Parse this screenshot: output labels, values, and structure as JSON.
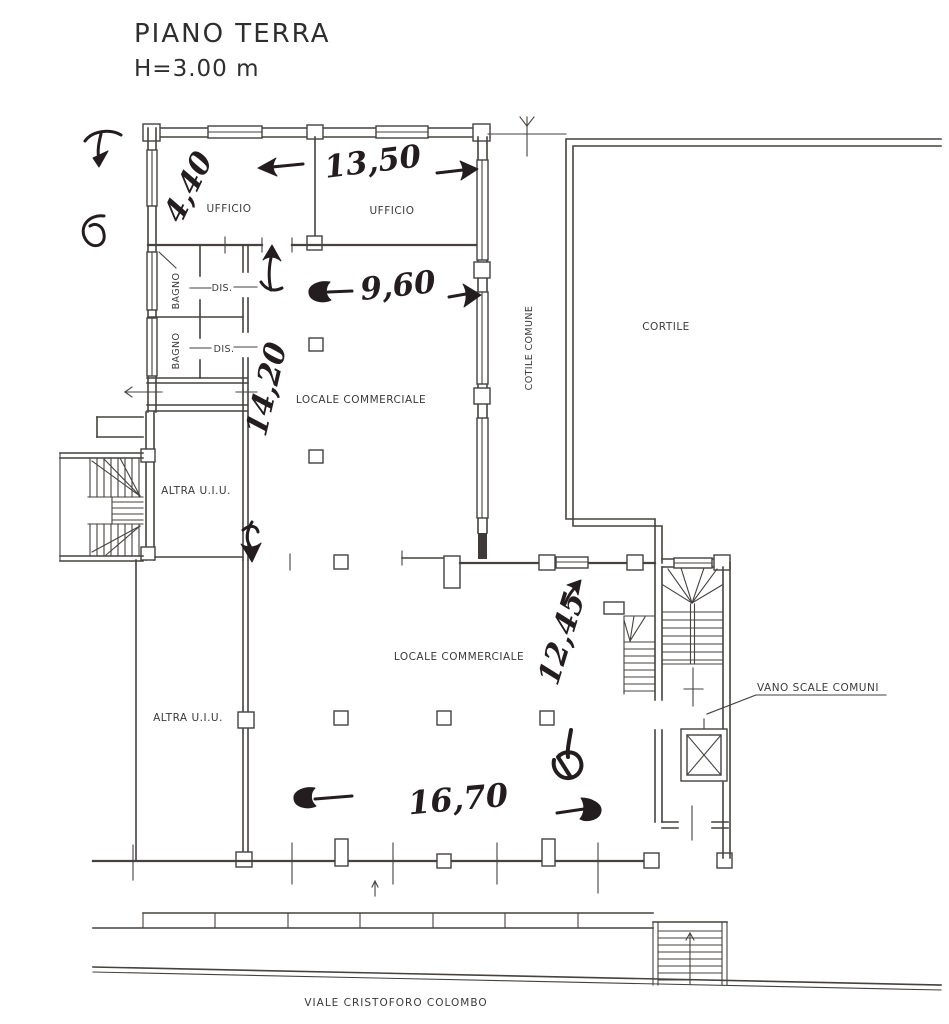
{
  "title": {
    "line1": "PIANO TERRA",
    "line2": "H=3.00 m"
  },
  "rooms": {
    "ufficio_left": "UFFICIO",
    "ufficio_right": "UFFICIO",
    "bagno_upper": "BAGNO",
    "bagno_lower": "BAGNO",
    "dis_upper": "DIS.",
    "dis_lower": "DIS.",
    "locale_upper": "LOCALE COMMERCIALE",
    "locale_lower": "LOCALE COMMERCIALE",
    "altra_upper": "ALTRA U.I.U.",
    "altra_lower": "ALTRA U.I.U.",
    "cortile": "CORTILE",
    "cotile_comune": "COTILE COMUNE",
    "vano_scale": "VANO SCALE COMUNI"
  },
  "street": {
    "name": "VIALE CRISTOFORO COLOMBO"
  },
  "measurements": {
    "m_4_40": "4,40",
    "m_13_50": "13,50",
    "m_9_60": "9,60",
    "m_14_20": "14,20",
    "m_12_45": "12,45",
    "m_16_70": "16,70"
  },
  "colors": {
    "plan_ink": "#45423f",
    "hand_ink": "#241d1f",
    "paper": "#ffffff"
  }
}
